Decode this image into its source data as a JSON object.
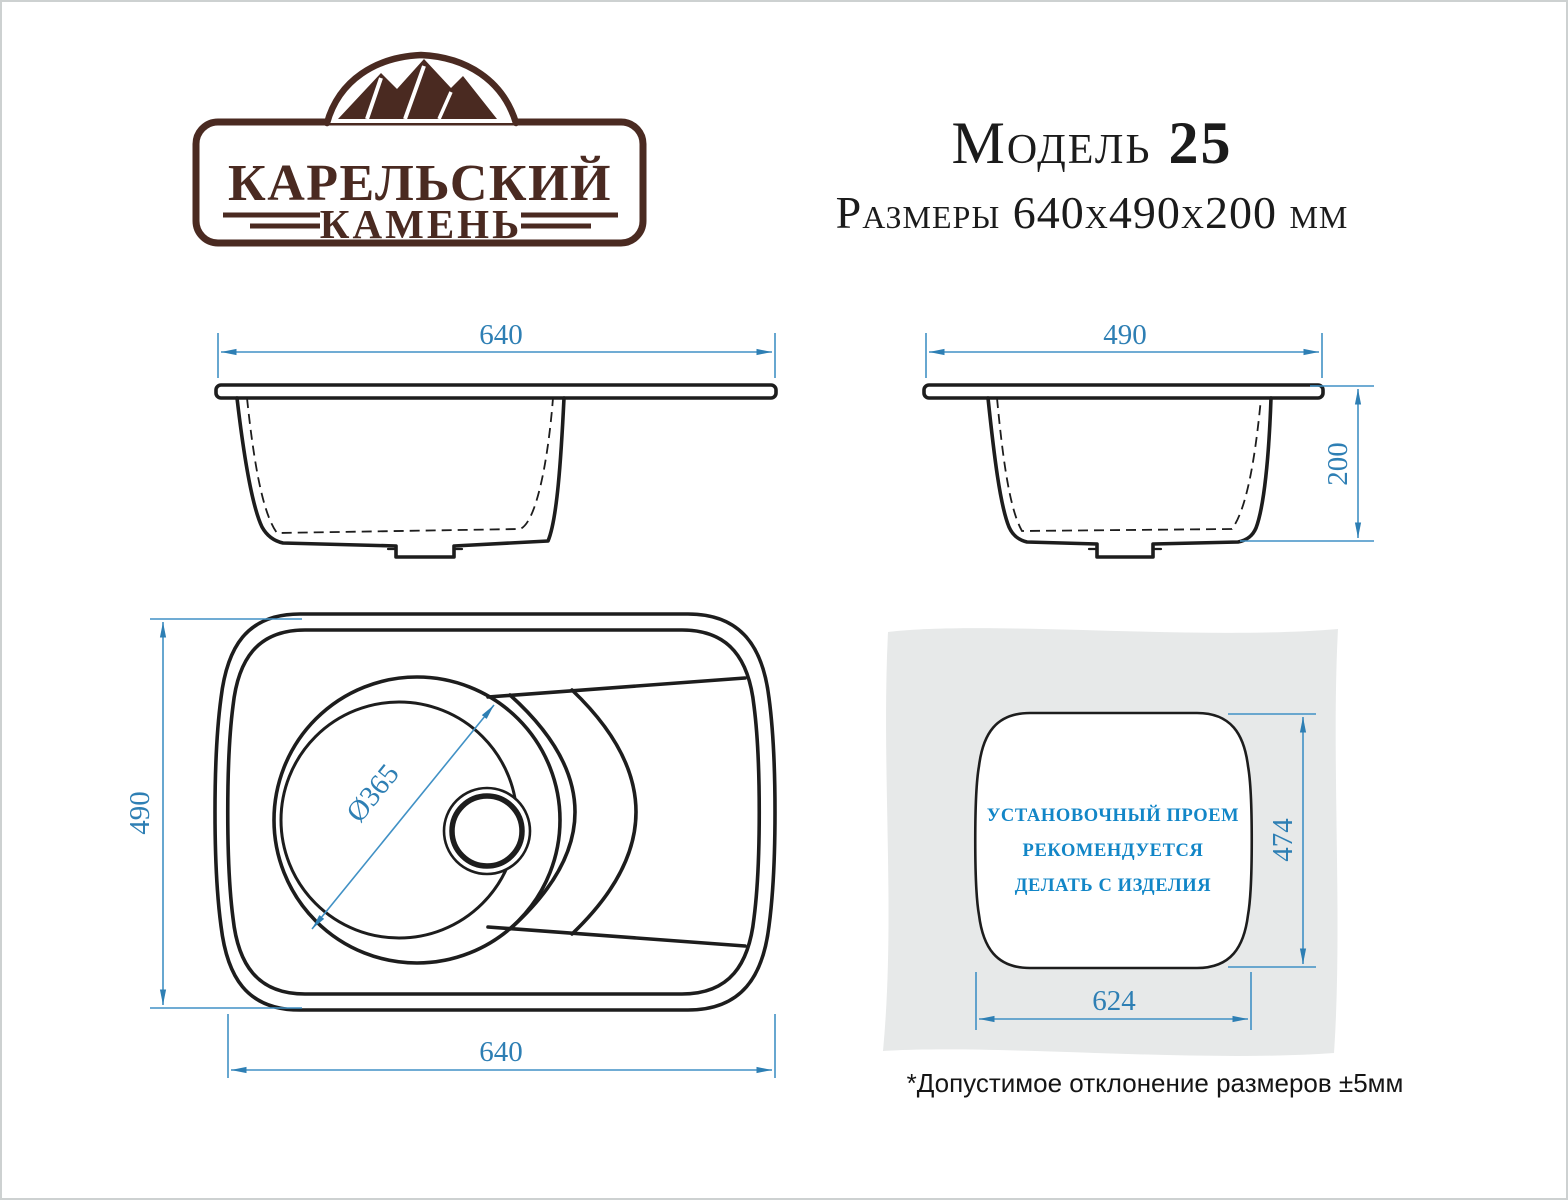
{
  "logo": {
    "brand_line1": "КАРЕЛЬСКИЙ",
    "brand_line2": "КАМЕНЬ"
  },
  "header": {
    "model_word": "Модель ",
    "model_number": "25",
    "dimensions_line": "Размеры 640x490x200 мм"
  },
  "views": {
    "front_section": {
      "width_dim": "640"
    },
    "side_section": {
      "width_dim": "490",
      "depth_dim": "200"
    },
    "top_view": {
      "height_dim": "490",
      "width_dim": "640",
      "bowl_diameter": "Ø365"
    },
    "installation": {
      "text_line1": "УСТАНОВОЧНЫЙ ПРОЕМ",
      "text_line2": "РЕКОМЕНДУЕТСЯ",
      "text_line3": "ДЕЛАТЬ С ИЗДЕЛИЯ",
      "height_dim": "474",
      "width_dim": "624"
    }
  },
  "footnote": "*Допустимое отклонение размеров ±5мм",
  "colors": {
    "dimension_blue": "#2e7fb4",
    "install_text_blue": "#1286c7",
    "logo_brown": "#4a2a21",
    "sheet_gray": "#e7e9e9",
    "line_black": "#1d1d1d"
  }
}
